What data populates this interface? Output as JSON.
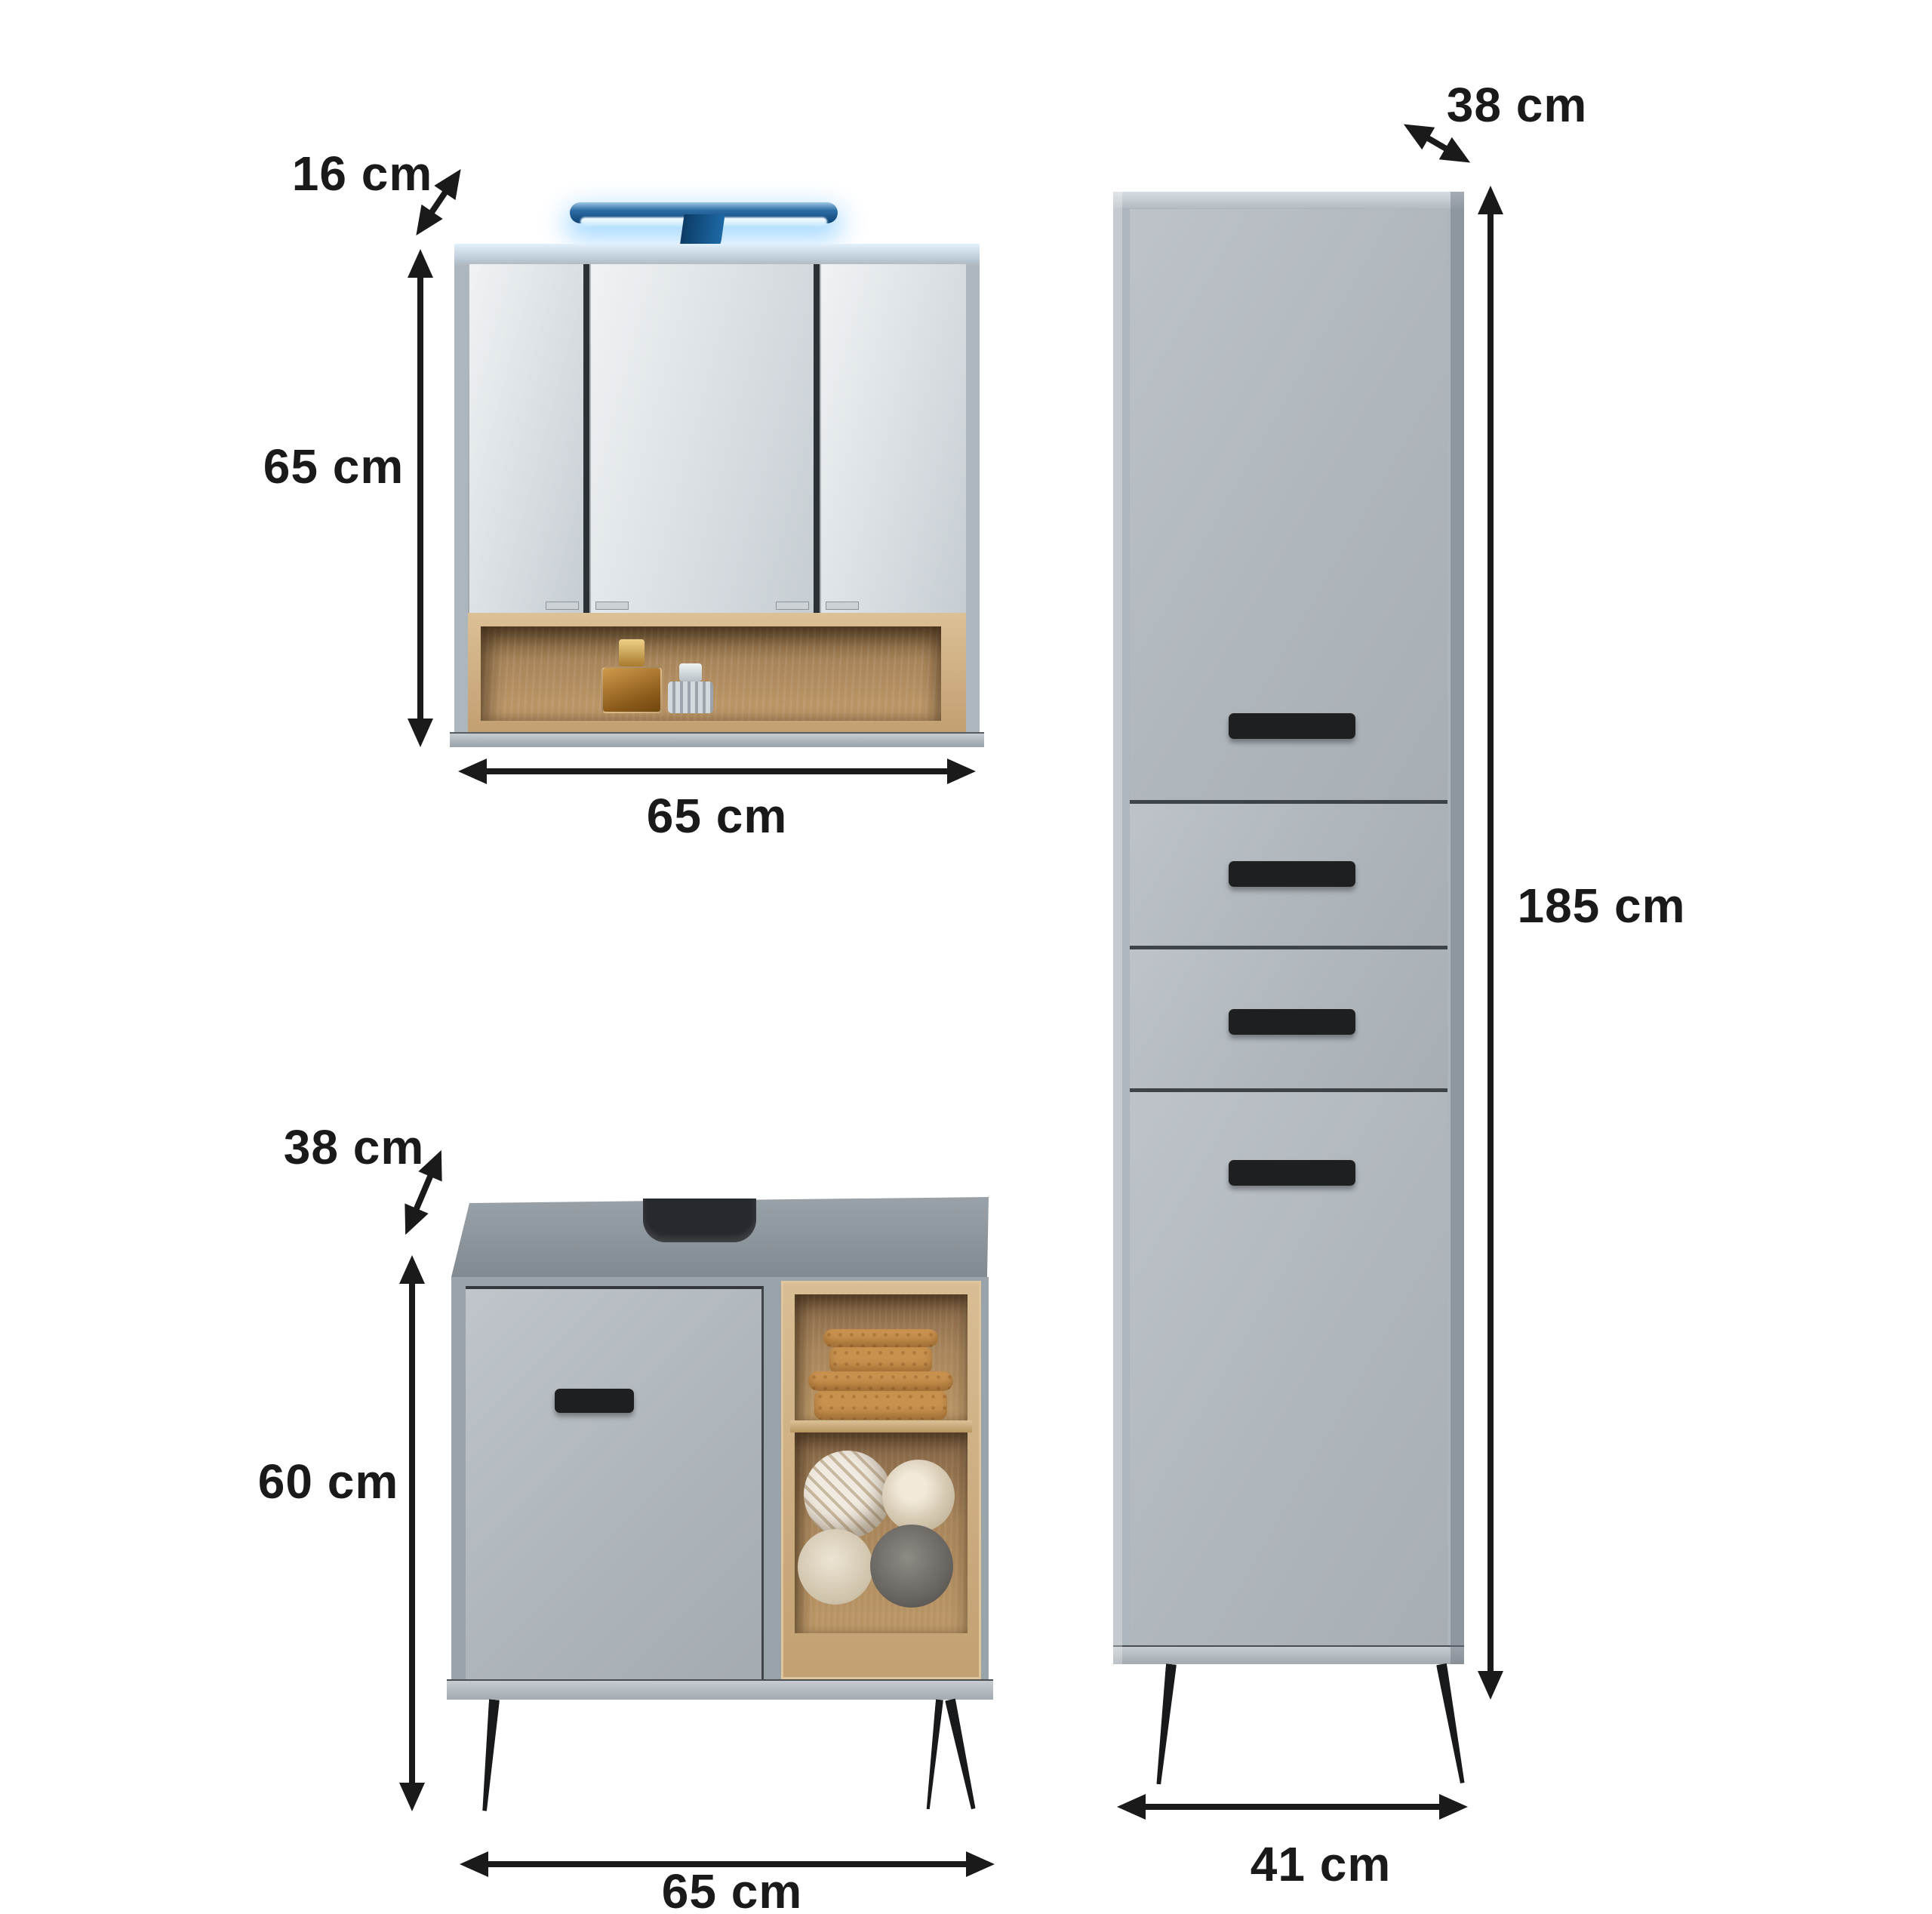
{
  "canvas": {
    "background": "#ffffff"
  },
  "colors": {
    "annotation": "#1a1a1a",
    "cabinet_gray": "#aeb6bd",
    "door_gray": "#b5bcc2",
    "wood_light": "#cfae80",
    "wood_dark": "#8a6a43",
    "led_blue": "#1f6aa6",
    "led_glow": "#cdeeff",
    "handle_black": "#1d1f21",
    "leg_black": "#17191a"
  },
  "items": [
    {
      "id": "mirror-cabinet",
      "dimensions": {
        "depth": "16 cm",
        "height": "65 cm",
        "width": "65 cm"
      }
    },
    {
      "id": "vanity-cabinet",
      "dimensions": {
        "depth": "38 cm",
        "height": "60 cm",
        "width": "65 cm"
      }
    },
    {
      "id": "tall-cabinet",
      "dimensions": {
        "depth": "38 cm",
        "height": "185 cm",
        "width": "41 cm"
      }
    }
  ]
}
